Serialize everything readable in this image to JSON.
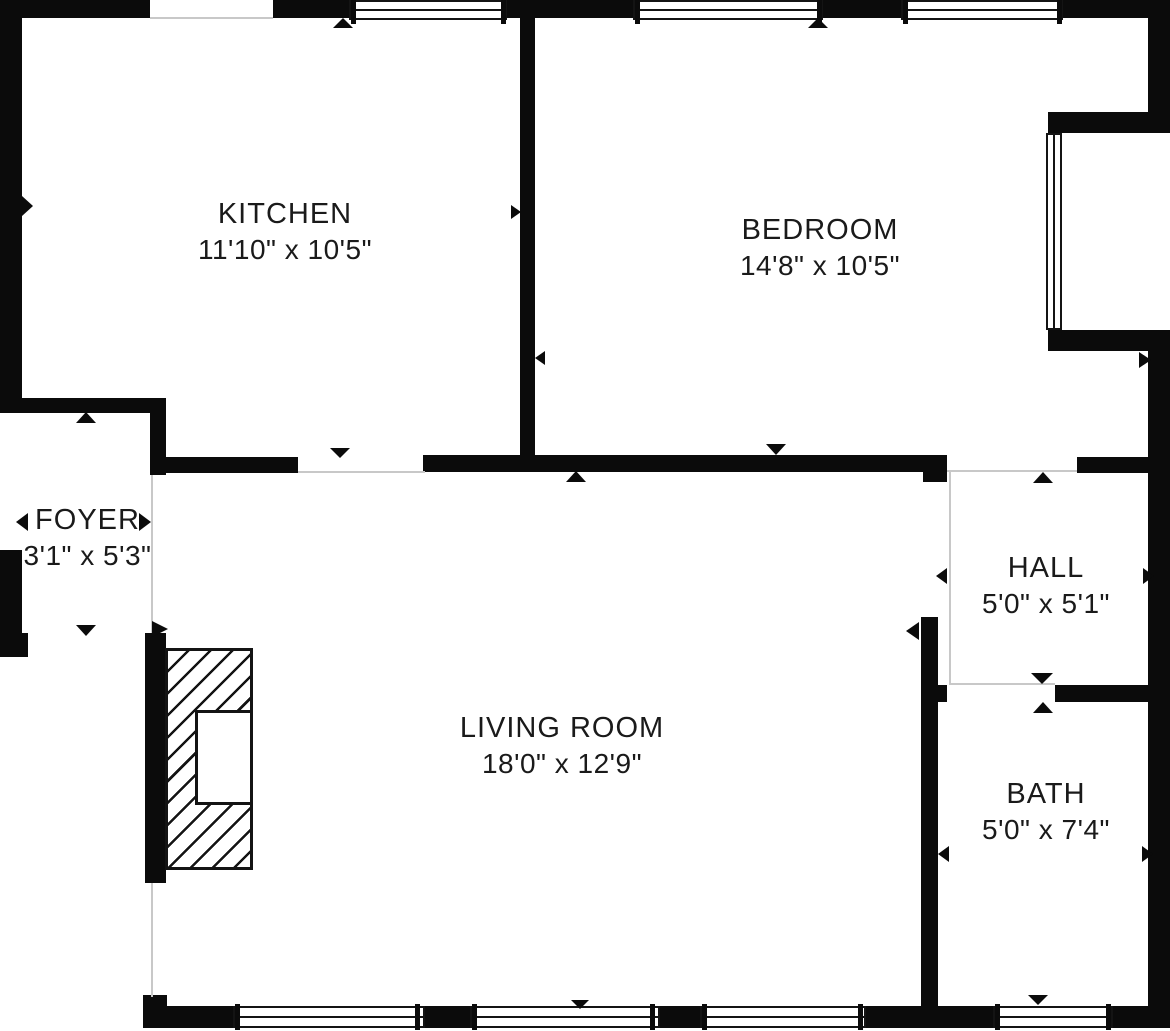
{
  "plan": {
    "title": "Apartment floor plan",
    "colors": {
      "wall": "#0b0b0b",
      "background": "#ffffff",
      "text": "#1a1a1a",
      "boundary_line": "#c8c8c8"
    },
    "rooms": [
      {
        "id": "kitchen",
        "name": "KITCHEN",
        "dimensions": "11'10\" x 10'5\""
      },
      {
        "id": "bedroom",
        "name": "BEDROOM",
        "dimensions": "14'8\" x 10'5\""
      },
      {
        "id": "foyer",
        "name": "FOYER",
        "dimensions": "3'1\" x 5'3\""
      },
      {
        "id": "hall",
        "name": "HALL",
        "dimensions": "5'0\" x 5'1\""
      },
      {
        "id": "living_room",
        "name": "LIVING ROOM",
        "dimensions": "18'0\" x 12'9\""
      },
      {
        "id": "bath",
        "name": "BATH",
        "dimensions": "5'0\" x 7'4\""
      }
    ]
  }
}
